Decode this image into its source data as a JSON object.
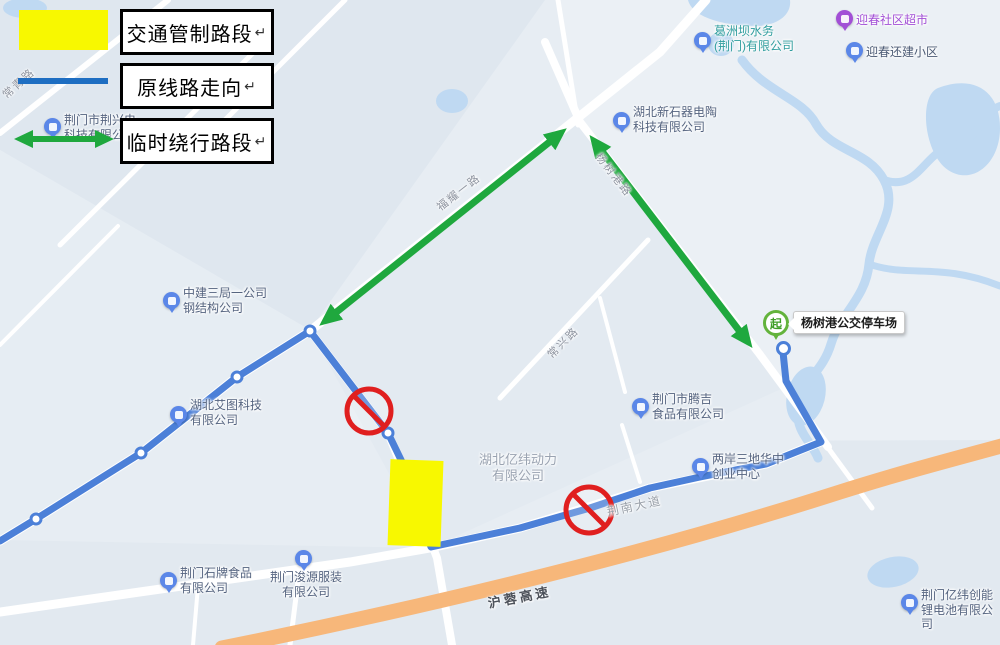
{
  "legend": {
    "items": [
      {
        "id": "control",
        "label": "交通管制路段",
        "mark": "↵",
        "swatch": "yellow-rect"
      },
      {
        "id": "original",
        "label": "原线路走向",
        "mark": "↵",
        "swatch": "blue-line"
      },
      {
        "id": "detour",
        "label": "临时绕行路段",
        "mark": "↵",
        "swatch": "green-double-arrow"
      }
    ]
  },
  "pois": {
    "jingxing": {
      "label": "荆门市荆兴电\n科技有限公"
    },
    "gezhouba": {
      "label": "葛洲坝水务\n(荆门)有限公司"
    },
    "yingchun_shop": {
      "label": "迎春社区超市"
    },
    "yingchun_estate": {
      "label": "迎春还建小区"
    },
    "xinshiqi": {
      "label": "湖北新石器电陶\n科技有限公司"
    },
    "zhongjian": {
      "label": "中建三局一公司\n钢结构公司"
    },
    "aitu": {
      "label": "湖北艾图科技\n有限公司"
    },
    "yiwei_power": {
      "label": "湖北亿纬动力\n有限公司"
    },
    "tengji": {
      "label": "荆门市腾吉\n食品有限公司"
    },
    "liangan": {
      "label": "两岸三地华中\n创业中心"
    },
    "shipai": {
      "label": "荆门石牌食品\n有限公司"
    },
    "junyuan": {
      "label": "荆门浚源服装\n有限公司"
    },
    "chuangneng": {
      "label": "荆门亿纬创能\n锂电池有限公司"
    }
  },
  "roads": {
    "changqing": "常青路",
    "fuyao": "福耀一路",
    "yangshugang": "杨树港路",
    "changxing": "常兴路",
    "jingnan": "荆南大道",
    "hurong": "沪蓉高速"
  },
  "bus_depot": {
    "label": "杨树港公交停车场",
    "start_pin": "起"
  },
  "colors": {
    "route_blue": "#4c80d8",
    "legend_blue": "#1e6ec2",
    "detour_green": "#1fa83e",
    "control_yellow": "#f8f800",
    "highway_orange": "#f7b77a",
    "no_entry_red": "#e01f1f",
    "water_blue": "#bfd9f2"
  }
}
